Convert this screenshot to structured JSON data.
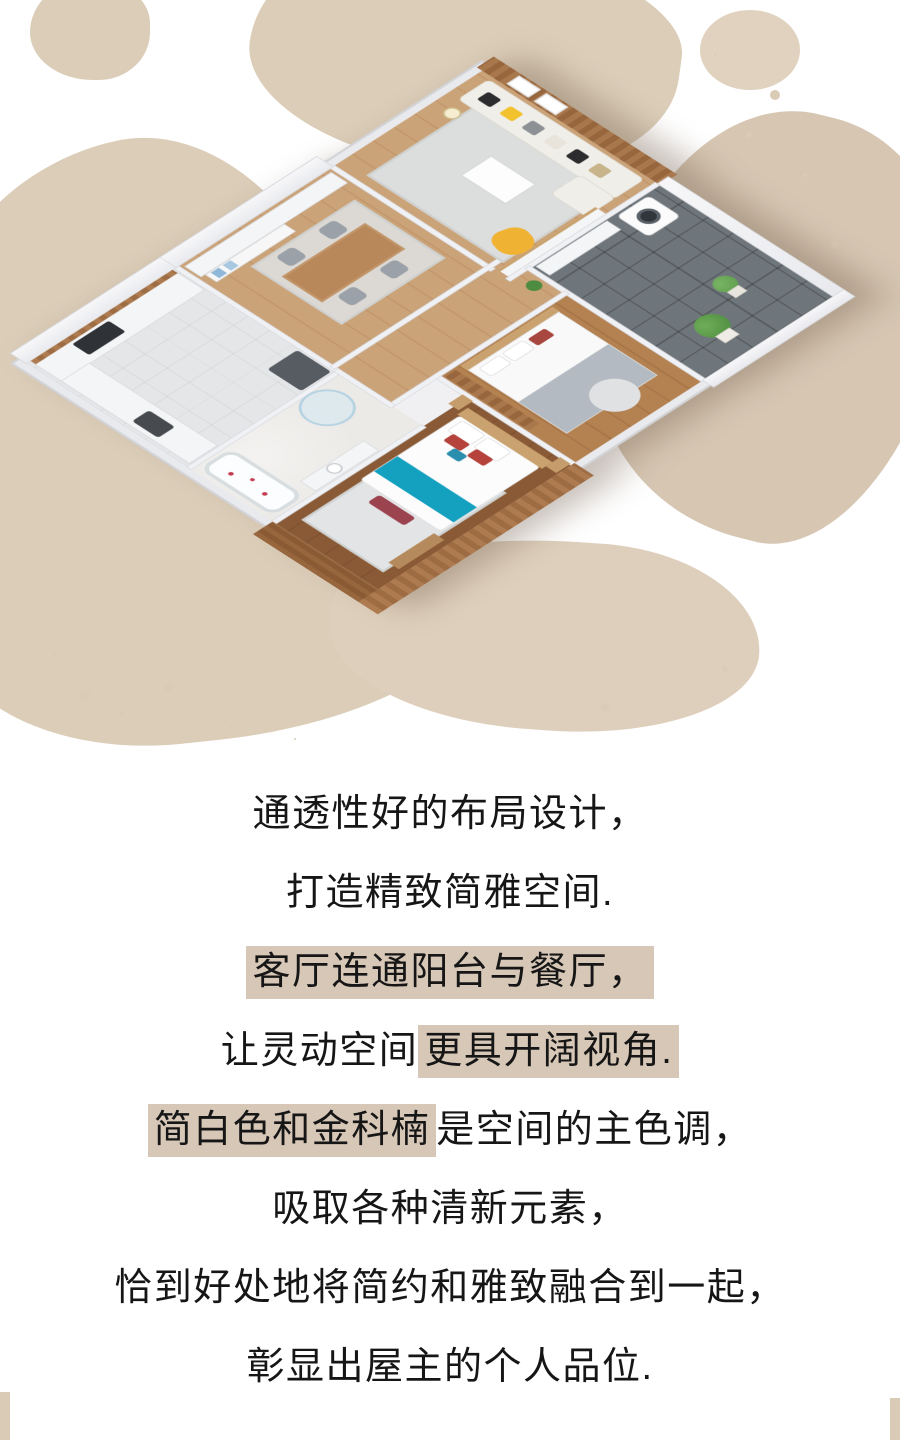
{
  "hero": {
    "description": "isometric 3D cutaway rendering of an apartment floor plan on a beige paint-splatter background",
    "splatter_color": "#dbcdb8",
    "palette": {
      "wood": "#a9774c",
      "wood_dark": "#8a5a34",
      "wall_white": "#f0f1f4",
      "teal_bed_runner": "#14a0bf",
      "accent_yellow_chair": "#f0b232",
      "sofa_white": "#f0eee8",
      "balcony_tile": "#6f767b",
      "plant_green": "#4c8b3f"
    },
    "rooms": [
      {
        "name": "kitchen"
      },
      {
        "name": "dining-area"
      },
      {
        "name": "living-room"
      },
      {
        "name": "hallway"
      },
      {
        "name": "bathroom"
      },
      {
        "name": "master-bedroom"
      },
      {
        "name": "second-bedroom"
      },
      {
        "name": "balcony-laundry"
      }
    ]
  },
  "article": {
    "text_color": "#161616",
    "highlight_color": "#d7c7b7",
    "lines": [
      {
        "segments": [
          {
            "text": "通透性好的布局设计，",
            "highlight": false
          }
        ]
      },
      {
        "segments": [
          {
            "text": "打造精致简雅空间.",
            "highlight": false
          }
        ]
      },
      {
        "segments": [
          {
            "text": "客厅连通阳台与餐厅，",
            "highlight": true
          }
        ]
      },
      {
        "segments": [
          {
            "text": "让灵动空间",
            "highlight": false
          },
          {
            "text": "更具开阔视角.",
            "highlight": true
          }
        ]
      },
      {
        "segments": [
          {
            "text": "简白色和金科楠",
            "highlight": true
          },
          {
            "text": "是空间的主色调，",
            "highlight": false
          }
        ]
      },
      {
        "segments": [
          {
            "text": "吸取各种清新元素，",
            "highlight": false
          }
        ]
      },
      {
        "segments": [
          {
            "text": "恰到好处地将简约和雅致融合到一起，",
            "highlight": false
          }
        ]
      },
      {
        "segments": [
          {
            "text": "彰显出屋主的个人品位.",
            "highlight": false
          }
        ]
      }
    ]
  }
}
